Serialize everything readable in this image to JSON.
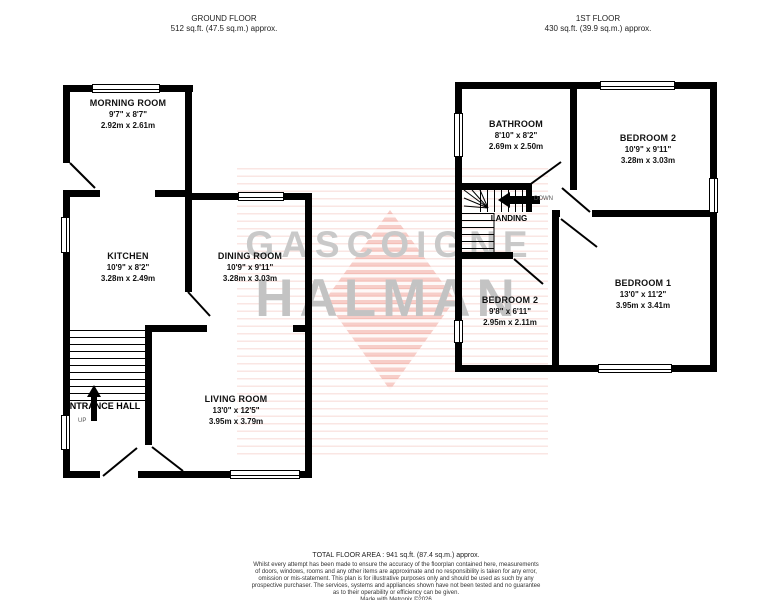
{
  "header": {
    "ground_floor": {
      "title": "GROUND FLOOR",
      "area": "512 sq.ft. (47.5 sq.m.) approx."
    },
    "first_floor": {
      "title": "1ST FLOOR",
      "area": "430 sq.ft. (39.9 sq.m.) approx."
    }
  },
  "watermark": {
    "line1": "GASCOIGNE",
    "line2": "HALMAN",
    "stripe_color": "#e87364",
    "text_color": "#c9c9c9"
  },
  "ground_floor": {
    "rooms": [
      {
        "name": "MORNING ROOM",
        "imperial": "9'7\" x 8'7\"",
        "metric": "2.92m x 2.61m"
      },
      {
        "name": "KITCHEN",
        "imperial": "10'9\" x 8'2\"",
        "metric": "3.28m x 2.49m"
      },
      {
        "name": "DINING ROOM",
        "imperial": "10'9\" x 9'11\"",
        "metric": "3.28m x 3.03m"
      },
      {
        "name": "LIVING ROOM",
        "imperial": "13'0\" x 12'5\"",
        "metric": "3.95m x 3.79m"
      },
      {
        "name": "ENTRANCE HALL"
      }
    ],
    "labels": {
      "up": "UP"
    }
  },
  "first_floor": {
    "rooms": [
      {
        "name": "BATHROOM",
        "imperial": "8'10\" x 8'2\"",
        "metric": "2.69m x 2.50m"
      },
      {
        "name": "BEDROOM 2",
        "imperial": "10'9\" x 9'11\"",
        "metric": "3.28m x 3.03m"
      },
      {
        "name": "BEDROOM 2",
        "imperial": "9'8\" x 6'11\"",
        "metric": "2.95m x 2.11m"
      },
      {
        "name": "BEDROOM 1",
        "imperial": "13'0\" x 11'2\"",
        "metric": "3.95m x 3.41m"
      },
      {
        "name": "LANDING"
      }
    ],
    "labels": {
      "down": "DOWN"
    }
  },
  "footer": {
    "total_area": "TOTAL FLOOR AREA : 941 sq.ft. (87.4 sq.m.) approx.",
    "disclaimer_lines": [
      "Whilst every attempt has been made to ensure the accuracy of the floorplan contained here, measurements",
      "of doors, windows, rooms and any other items are approximate and no responsibility is taken for any error,",
      "omission or mis-statement. This plan is for illustrative purposes only and should be used as such by any",
      "prospective purchaser. The services, systems and appliances shown have not been tested and no guarantee",
      "as to their operability or efficiency can be given."
    ],
    "credit": "Made with Metropix ©2026"
  }
}
